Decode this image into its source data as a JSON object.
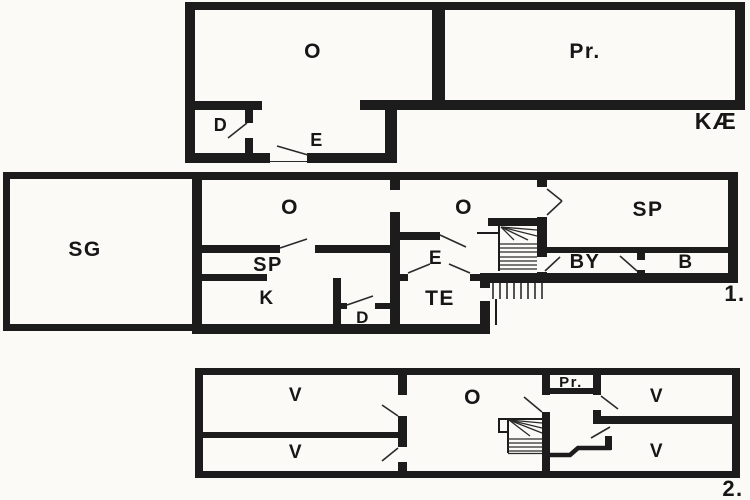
{
  "plan": {
    "type": "floor-plan",
    "colors": {
      "wall": "#1c1c1c",
      "background": "#fbfaf7",
      "text": "#161616"
    },
    "floors": {
      "basement": {
        "tag": "KÆ",
        "o": "O",
        "pr": "Pr.",
        "d": "D",
        "e": "E"
      },
      "first": {
        "tag": "1.",
        "sg": "SG",
        "o1": "O",
        "o2": "O",
        "sp1": "SP",
        "k": "K",
        "d": "D",
        "e": "E",
        "te": "TE",
        "sp2": "SP",
        "by": "BY",
        "b": "B"
      },
      "second": {
        "tag": "2.",
        "v1": "V",
        "v2": "V",
        "o": "O",
        "pr": "Pr.",
        "v3": "V",
        "v4": "V"
      }
    }
  }
}
